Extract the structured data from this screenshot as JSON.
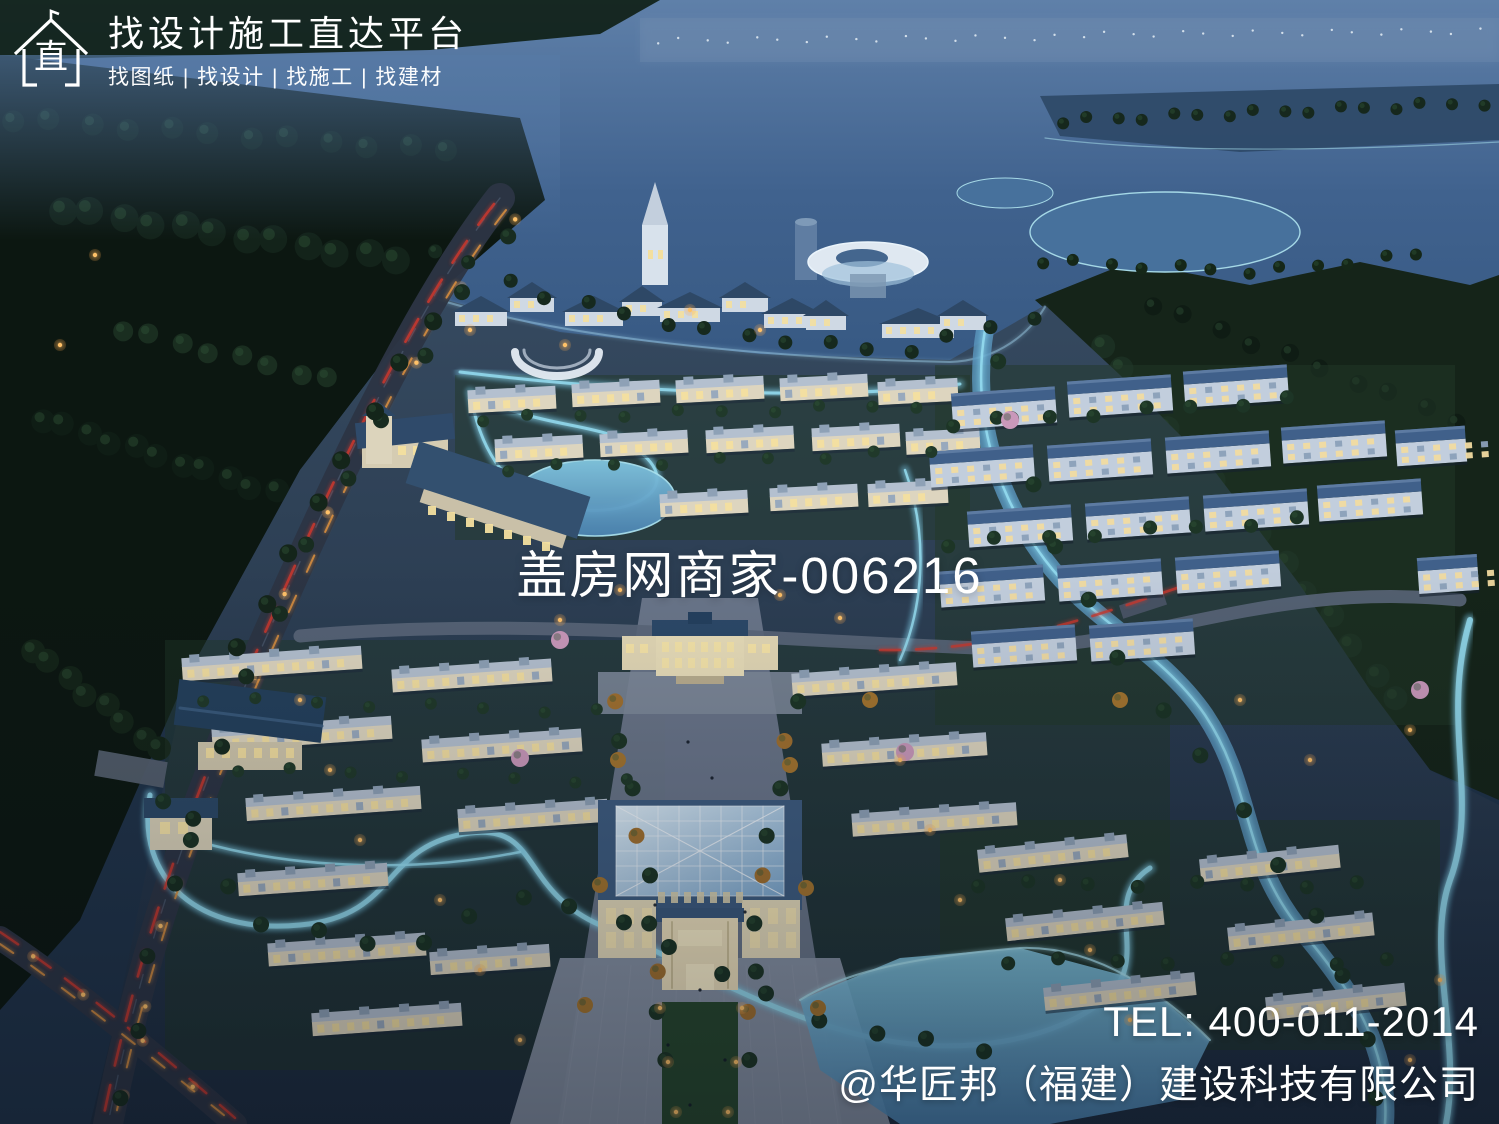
{
  "branding": {
    "platform_title": "找设计施工直达平台",
    "platform_subtitle": "找图纸 | 找设计 | 找施工 | 找建材",
    "logo_glyph": "直"
  },
  "watermark": {
    "merchant_id": "盖房网商家-006216"
  },
  "contact": {
    "tel": "TEL: 400-011-2014",
    "company": "@华匠邦（福建）建设科技有限公司"
  },
  "palette": {
    "lake_blue": "#40628e",
    "canal_glow": "#8fd6ea",
    "roof_blue": "#3c5c82",
    "warm_window": "#f3df9f",
    "street_lamp": "#ffc168",
    "tail_light": "#c9392f",
    "forest_dark": "#13231a",
    "overlay_text": "#ffffff"
  }
}
